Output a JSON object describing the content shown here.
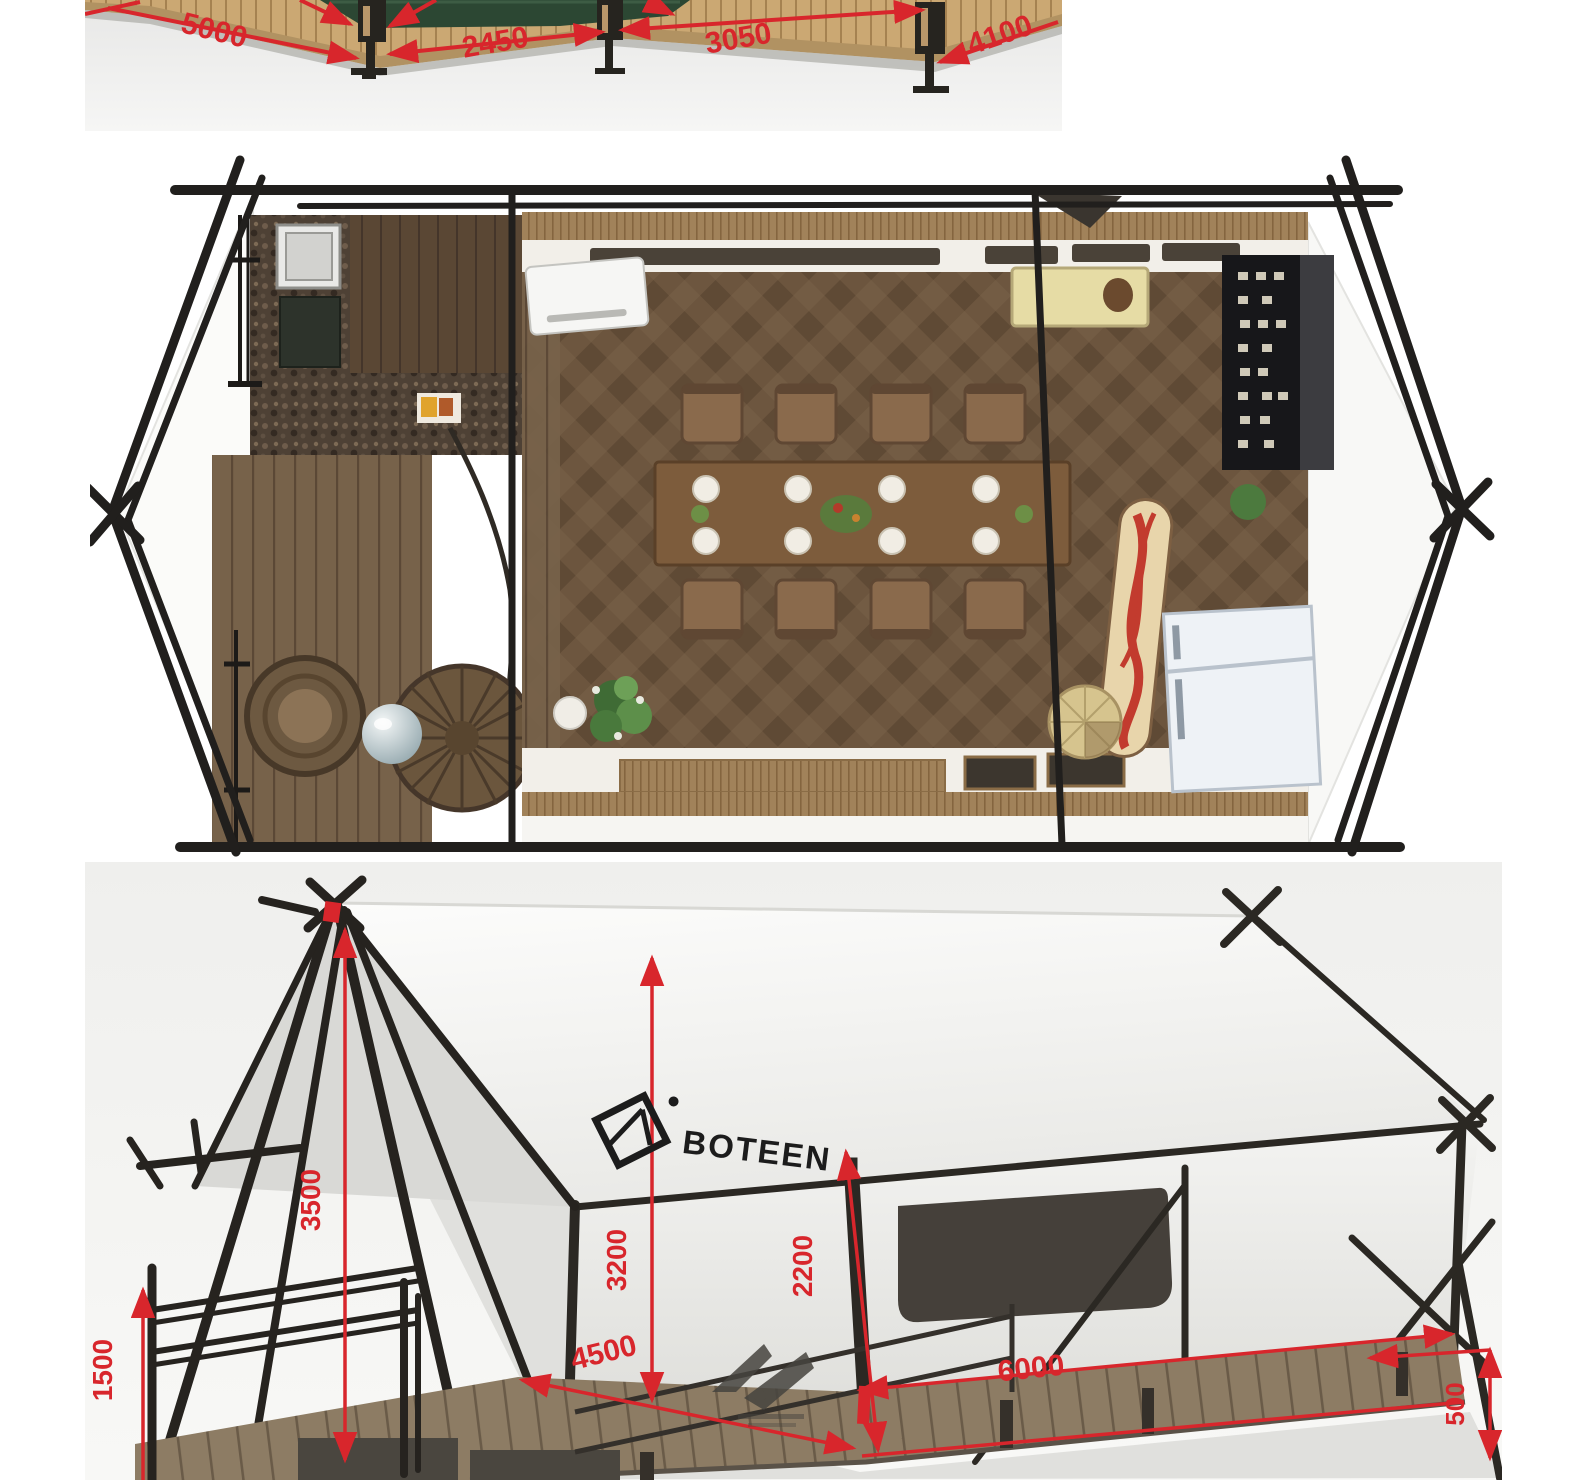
{
  "figures": {
    "top_view": {
      "dims": {
        "left": "5000",
        "front_left": "2450",
        "front_right": "3050",
        "right": "4100"
      }
    },
    "side_view": {
      "brand": "BOTEEN",
      "dims": {
        "peak_height": "3500",
        "rail_height": "1500",
        "wall_height": "3200",
        "eave_height": "2200",
        "side_depth": "4500",
        "front_width": "6000",
        "deck_height": "500"
      }
    }
  },
  "colors": {
    "dimension_red": "#d8262c",
    "frame_dark": "#26231f",
    "canvas_white": "#f4f4f2",
    "deck_wood": "#8d7c64",
    "floor_wood": "#6d563f",
    "tan_deck": "#cba873",
    "tent_green": "#2c4733"
  }
}
